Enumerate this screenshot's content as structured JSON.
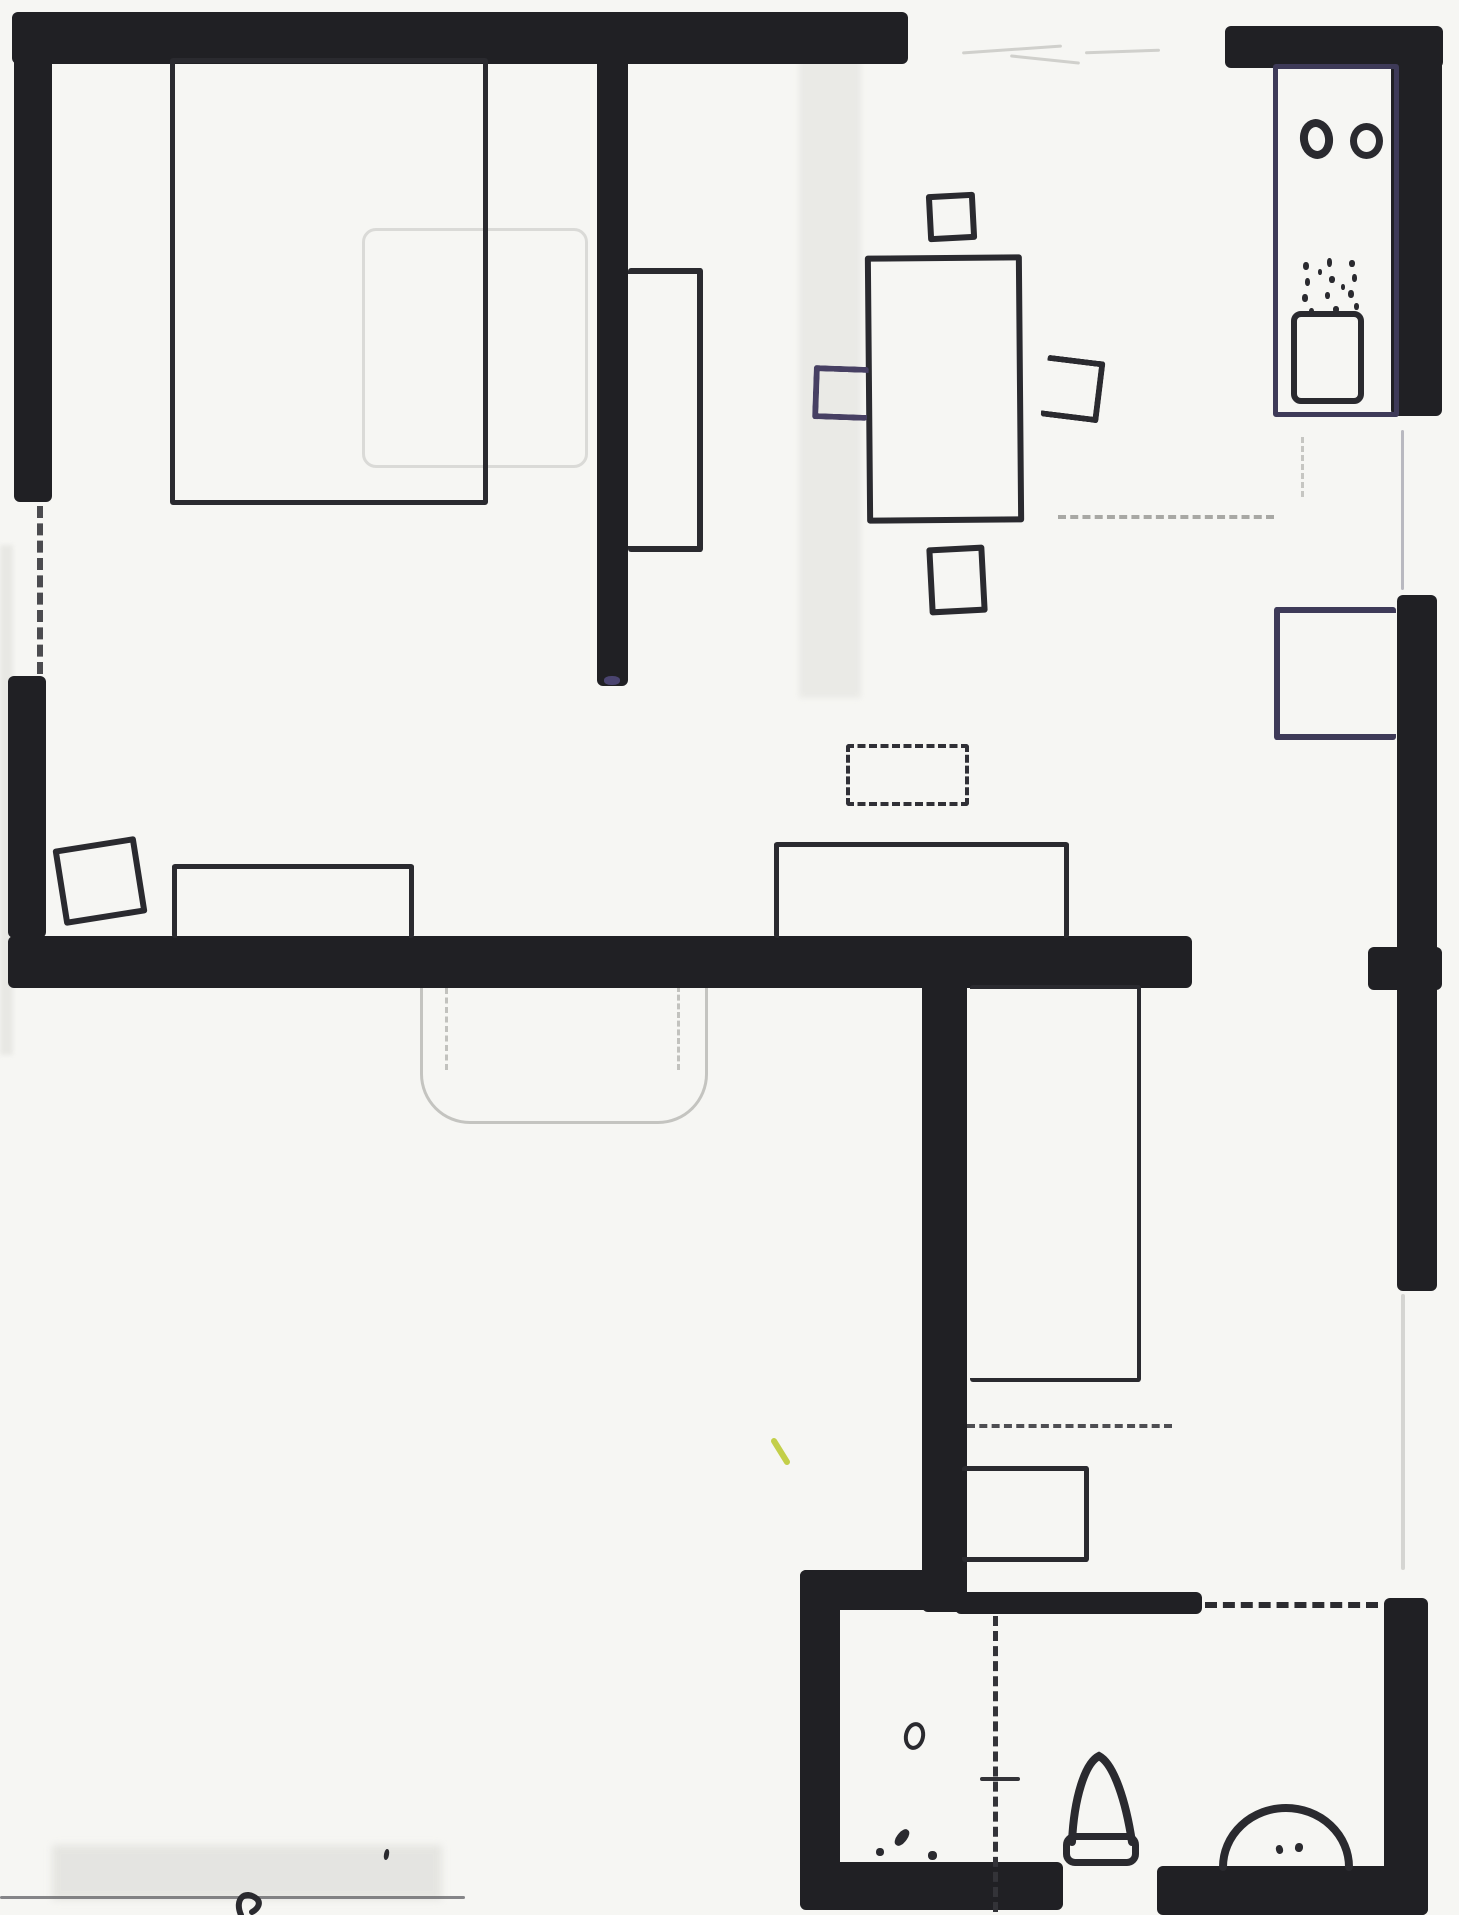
{
  "document": {
    "kind": "hand-drawn apartment floor plan, black ink on scanned white paper",
    "canvas_width": 1459,
    "canvas_height": 1915
  },
  "palette": {
    "paper": "#f6f6f3",
    "ink_wall": "#202024",
    "ink": "#2a2a2f",
    "ink_navy": "#3e3a58",
    "ink_blue_chair": "#474063",
    "pencil": "#bdbdb9",
    "pencil_soft": "#d6d6d2",
    "yellow_mark": "#c3cf49"
  },
  "walls": [
    {
      "name": "wall-top",
      "x": 12,
      "y": 12,
      "w": 896,
      "h": 52
    },
    {
      "name": "wall-kitchen-top",
      "x": 1225,
      "y": 26,
      "w": 218,
      "h": 42
    },
    {
      "name": "wall-left-upper",
      "x": 14,
      "y": 12,
      "w": 38,
      "h": 490
    },
    {
      "name": "wall-left-lower",
      "x": 8,
      "y": 676,
      "w": 38,
      "h": 262
    },
    {
      "name": "wall-center-vertical",
      "x": 597,
      "y": 56,
      "w": 31,
      "h": 630
    },
    {
      "name": "wall-middle-horizontal",
      "x": 8,
      "y": 936,
      "w": 1184,
      "h": 52
    },
    {
      "name": "wall-lower-vertical",
      "x": 922,
      "y": 974,
      "w": 45,
      "h": 638
    },
    {
      "name": "wall-right-kitchen",
      "x": 1391,
      "y": 30,
      "w": 51,
      "h": 386
    },
    {
      "name": "wall-right-middle",
      "x": 1397,
      "y": 595,
      "w": 40,
      "h": 696
    },
    {
      "name": "wall-right-nub",
      "x": 1368,
      "y": 947,
      "w": 74,
      "h": 43
    },
    {
      "name": "wall-bath-top-left",
      "x": 800,
      "y": 1570,
      "w": 160,
      "h": 40
    },
    {
      "name": "wall-bath-left",
      "x": 800,
      "y": 1570,
      "w": 40,
      "h": 338
    },
    {
      "name": "wall-bath-bottom-left",
      "x": 800,
      "y": 1862,
      "w": 263,
      "h": 48
    },
    {
      "name": "wall-bath-top-right",
      "x": 955,
      "y": 1592,
      "w": 247,
      "h": 22
    },
    {
      "name": "wall-bath-bottom-right",
      "x": 1157,
      "y": 1866,
      "w": 271,
      "h": 49
    },
    {
      "name": "wall-bath-right",
      "x": 1384,
      "y": 1598,
      "w": 44,
      "h": 317
    }
  ],
  "smudges": [
    {
      "name": "hallway-smudge-strip",
      "x": 799,
      "y": 58,
      "w": 62,
      "h": 640,
      "color": "#e9e9e5",
      "blur": 3,
      "opacity": 0.9
    },
    {
      "name": "left-edge-smudge",
      "x": 0,
      "y": 545,
      "w": 13,
      "h": 510,
      "color": "#e7e7e3",
      "blur": 2,
      "opacity": 0.9
    },
    {
      "name": "bottom-left-smudge",
      "x": 52,
      "y": 1845,
      "w": 390,
      "h": 55,
      "color": "#e2e2de",
      "blur": 4,
      "opacity": 0.85
    }
  ],
  "pencil_marks": [
    {
      "name": "pencil-ghost-bed",
      "kind": "box",
      "x": 362,
      "y": 228,
      "w": 226,
      "h": 240,
      "stroke": 3,
      "sides": "all",
      "color": "#c8c8c4",
      "radius": "14px",
      "opacity": 0.6
    },
    {
      "name": "pencil-nook-outline",
      "kind": "box",
      "x": 420,
      "y": 982,
      "w": 288,
      "h": 142,
      "stroke": 3,
      "sides": "lrb",
      "color": "#b8b8b4",
      "radius": "0 0 50px 50px",
      "opacity": 0.8
    },
    {
      "name": "pencil-nook-dash-left",
      "kind": "dash-v",
      "x": 445,
      "y": 988,
      "h": 82,
      "stroke": 3,
      "color": "#c2c2be"
    },
    {
      "name": "pencil-nook-dash-right",
      "kind": "dash-v",
      "x": 677,
      "y": 986,
      "h": 84,
      "stroke": 3,
      "color": "#c2c2be"
    },
    {
      "name": "pencil-right-wall-gap-line",
      "kind": "line-v",
      "x": 1401,
      "y": 1294,
      "h": 276,
      "stroke": 4,
      "color": "#cdcdc9",
      "opacity": 0.8
    },
    {
      "name": "pencil-dash-under-counter",
      "kind": "dash-v",
      "x": 1301,
      "y": 437,
      "h": 60,
      "stroke": 3,
      "color": "#c6c6c2"
    },
    {
      "name": "pencil-scribble-1",
      "kind": "line-h",
      "x": 962,
      "y": 48,
      "w": 100,
      "stroke": 3,
      "color": "#d0d0cc",
      "rotate": -4
    },
    {
      "name": "pencil-scribble-2",
      "kind": "line-h",
      "x": 1010,
      "y": 58,
      "w": 70,
      "stroke": 3,
      "color": "#d0d0cc",
      "rotate": 6
    },
    {
      "name": "pencil-scribble-3",
      "kind": "line-h",
      "x": 1085,
      "y": 50,
      "w": 75,
      "stroke": 3,
      "color": "#d0d0cc",
      "rotate": -2
    }
  ],
  "furniture": [
    {
      "name": "bed-1-outline",
      "kind": "box",
      "x": 170,
      "y": 58,
      "w": 318,
      "h": 447,
      "stroke": 5,
      "sides": "all"
    },
    {
      "name": "wall-shelf-outline",
      "kind": "box",
      "x": 628,
      "y": 268,
      "w": 75,
      "h": 284,
      "stroke": 6,
      "sides": "trb"
    },
    {
      "name": "dining-table-outline",
      "kind": "box",
      "x": 866,
      "y": 255,
      "w": 157,
      "h": 268,
      "stroke": 6,
      "sides": "all",
      "rotate": -0.5
    },
    {
      "name": "dining-chair-top",
      "kind": "box",
      "x": 927,
      "y": 193,
      "w": 49,
      "h": 48,
      "stroke": 6,
      "sides": "all",
      "rotate": -3
    },
    {
      "name": "dining-chair-left",
      "kind": "box",
      "x": 813,
      "y": 366,
      "w": 55,
      "h": 54,
      "stroke": 6,
      "sides": "tlb",
      "color": "#474063",
      "rotate": 2
    },
    {
      "name": "dining-chair-right",
      "kind": "box",
      "x": 1044,
      "y": 358,
      "w": 58,
      "h": 62,
      "stroke": 6,
      "sides": "trb",
      "rotate": 7
    },
    {
      "name": "dining-chair-bottom",
      "kind": "box",
      "x": 928,
      "y": 546,
      "w": 58,
      "h": 68,
      "stroke": 6,
      "sides": "all",
      "rotate": -3
    },
    {
      "name": "kitchen-counter-outline",
      "kind": "box",
      "x": 1273,
      "y": 64,
      "w": 126,
      "h": 353,
      "stroke": 5,
      "sides": "all",
      "color": "#3e3a58"
    },
    {
      "name": "kitchen-oven-outline",
      "kind": "box",
      "x": 1291,
      "y": 311,
      "w": 73,
      "h": 93,
      "stroke": 6,
      "sides": "all",
      "radius": "10px"
    },
    {
      "name": "storage-box-right-wall",
      "kind": "box",
      "x": 1274,
      "y": 607,
      "w": 122,
      "h": 133,
      "stroke": 6,
      "sides": "tlb",
      "color": "#3e3a58"
    },
    {
      "name": "sofa-outline",
      "kind": "box",
      "x": 172,
      "y": 864,
      "w": 242,
      "h": 74,
      "stroke": 5,
      "sides": "tlr"
    },
    {
      "name": "armchair-outline",
      "kind": "box",
      "x": 58,
      "y": 842,
      "w": 84,
      "h": 78,
      "stroke": 6,
      "sides": "all",
      "rotate": -9
    },
    {
      "name": "tv-bench-outline",
      "kind": "box",
      "x": 774,
      "y": 842,
      "w": 295,
      "h": 96,
      "stroke": 5,
      "sides": "tlr"
    },
    {
      "name": "bed-2-outline",
      "kind": "box",
      "x": 970,
      "y": 985,
      "w": 171,
      "h": 397,
      "stroke": 4,
      "sides": "trb"
    },
    {
      "name": "closet-outline",
      "kind": "box",
      "x": 962,
      "y": 1466,
      "w": 127,
      "h": 96,
      "stroke": 5,
      "sides": "trb"
    },
    {
      "name": "toilet-tank",
      "kind": "box",
      "x": 1063,
      "y": 1833,
      "w": 76,
      "h": 33,
      "stroke": 7,
      "sides": "all",
      "radius": "12px"
    }
  ],
  "dashed_lines": [
    {
      "name": "window-dash-left-wall",
      "kind": "dash-v",
      "x": 37,
      "y": 506,
      "h": 168,
      "stroke": 6,
      "color": "#4b4b4f"
    },
    {
      "name": "window-line-right-wall",
      "kind": "line-v",
      "x": 1401,
      "y": 430,
      "h": 160,
      "stroke": 3,
      "color": "#b9b9c0"
    },
    {
      "name": "rug-dashed-outline",
      "kind": "dash-box",
      "x": 846,
      "y": 744,
      "w": 123,
      "h": 62,
      "stroke": 4,
      "color": "#303036"
    },
    {
      "name": "kitchen-boundary-dash",
      "kind": "dash-h",
      "x": 1058,
      "y": 515,
      "w": 216,
      "stroke": 4,
      "color": "#a8a8a4"
    },
    {
      "name": "closet-boundary-dash",
      "kind": "dash-h",
      "x": 967,
      "y": 1424,
      "w": 205,
      "stroke": 4,
      "color": "#4e4e52"
    },
    {
      "name": "bath-entry-dash",
      "kind": "dash-h",
      "x": 1205,
      "y": 1602,
      "w": 173,
      "stroke": 6,
      "color": "#2c2c30"
    },
    {
      "name": "bath-door-dash",
      "kind": "dash-v",
      "x": 993,
      "y": 1616,
      "h": 296,
      "stroke": 5,
      "color": "#333338"
    },
    {
      "name": "bath-door-tick",
      "kind": "line-h",
      "x": 980,
      "y": 1777,
      "w": 40,
      "stroke": 4,
      "color": "#333338"
    },
    {
      "name": "page-bottom-line",
      "kind": "line-h",
      "x": 0,
      "y": 1896,
      "w": 465,
      "stroke": 3,
      "color": "#55555a",
      "opacity": 0.7
    }
  ],
  "ellipses": [
    {
      "name": "kitchen-sink-basin-left",
      "x": 1300,
      "y": 119,
      "w": 33,
      "h": 40,
      "stroke": 8,
      "rotate": -8
    },
    {
      "name": "kitchen-sink-basin-right",
      "x": 1350,
      "y": 123,
      "w": 33,
      "h": 36,
      "stroke": 7
    },
    {
      "name": "bathroom-floor-drain",
      "x": 904,
      "y": 1722,
      "w": 21,
      "h": 28,
      "stroke": 4,
      "rotate": 12
    }
  ],
  "dots": [
    {
      "name": "stove-burner-dot",
      "x": 1303,
      "y": 262,
      "w": 6,
      "h": 8
    },
    {
      "name": "stove-burner-dot",
      "x": 1327,
      "y": 258,
      "w": 5,
      "h": 9
    },
    {
      "name": "stove-burner-dot",
      "x": 1349,
      "y": 260,
      "w": 6,
      "h": 7
    },
    {
      "name": "stove-burner-dot",
      "x": 1305,
      "y": 278,
      "w": 5,
      "h": 8
    },
    {
      "name": "stove-burner-dot",
      "x": 1329,
      "y": 276,
      "w": 6,
      "h": 7
    },
    {
      "name": "stove-burner-dot",
      "x": 1352,
      "y": 274,
      "w": 5,
      "h": 8
    },
    {
      "name": "stove-burner-dot",
      "x": 1302,
      "y": 294,
      "w": 6,
      "h": 8
    },
    {
      "name": "stove-burner-dot",
      "x": 1325,
      "y": 292,
      "w": 5,
      "h": 7
    },
    {
      "name": "stove-burner-dot",
      "x": 1348,
      "y": 290,
      "w": 6,
      "h": 8
    },
    {
      "name": "stove-burner-dot",
      "x": 1309,
      "y": 308,
      "w": 5,
      "h": 7
    },
    {
      "name": "stove-burner-dot",
      "x": 1333,
      "y": 306,
      "w": 6,
      "h": 7
    },
    {
      "name": "stove-burner-dot",
      "x": 1354,
      "y": 303,
      "w": 5,
      "h": 7
    },
    {
      "name": "stove-burner-dot",
      "x": 1318,
      "y": 269,
      "w": 4,
      "h": 6
    },
    {
      "name": "stove-burner-dot",
      "x": 1341,
      "y": 284,
      "w": 4,
      "h": 6
    },
    {
      "name": "wall-tip-blue-mark",
      "x": 604,
      "y": 676,
      "w": 16,
      "h": 9,
      "color": "#4a4470"
    },
    {
      "name": "ink-blob-1",
      "x": 897,
      "y": 1828,
      "w": 10,
      "h": 19,
      "rotate": 38
    },
    {
      "name": "ink-blob-2",
      "x": 876,
      "y": 1848,
      "w": 8,
      "h": 8
    },
    {
      "name": "ink-blob-3",
      "x": 928,
      "y": 1851,
      "w": 9,
      "h": 9
    },
    {
      "name": "ink-dot-bottom-left",
      "x": 384,
      "y": 1849,
      "w": 5,
      "h": 11,
      "rotate": 10
    },
    {
      "name": "bath-sink-faucet-left",
      "x": 1276,
      "y": 1845,
      "w": 7,
      "h": 9,
      "rotate": -15
    },
    {
      "name": "bath-sink-faucet-right",
      "x": 1295,
      "y": 1843,
      "w": 8,
      "h": 9,
      "rotate": 10
    }
  ],
  "paths": [
    {
      "name": "toilet-bowl",
      "d": "M 1072 1842 C 1074 1798 1085 1763 1099 1756 C 1114 1764 1126 1802 1132 1842",
      "w": 8
    },
    {
      "name": "bath-sink-basin",
      "d": "M 1223 1867 A 63 59 0 0 1 1349 1867",
      "w": 8
    },
    {
      "name": "page-corner-squiggle",
      "d": "M 241 1915 C 234 1899 245 1889 257 1899 C 261 1903 258 1909 252 1912",
      "w": 6
    },
    {
      "name": "yellow-pen-mark",
      "d": "M 774 1441 L 787 1462",
      "w": 6,
      "color": "#c3cf49"
    }
  ]
}
